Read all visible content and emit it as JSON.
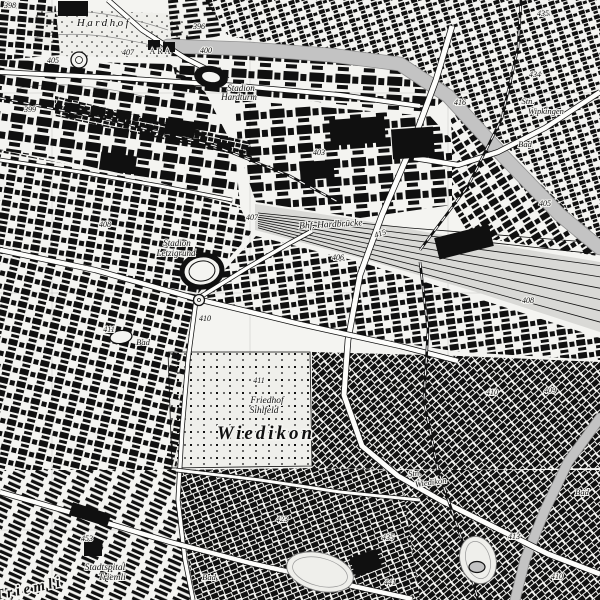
{
  "canvas": {
    "width": 600,
    "height": 600
  },
  "colors": {
    "background": "#f4f4f1",
    "ink": "#101010",
    "river": "#c3c3c3",
    "river_edge": "#909090",
    "yard": "#d9d9d6",
    "road_fill": "#fdfdfb",
    "grid": "#9a9a9a",
    "contour": "#8a8a8a",
    "area_light": "#efefeb"
  },
  "grid": {
    "vertical_x": [
      52,
      250,
      448
    ],
    "horizontal_y": [
      93,
      293,
      530
    ]
  },
  "parks": [
    {
      "name": "hardhof-park",
      "points": "38,8 178,14 196,44 168,58 58,56 30,30",
      "tile": "dots",
      "outline": false
    },
    {
      "name": "cemetery-sihlfeld",
      "points": "168,352 310,352 312,466 172,468",
      "tile": "cem",
      "outline": true
    }
  ],
  "contours": [
    "M40,14 C80,6 125,16 168,30",
    "M34,38 C82,28 130,40 172,50",
    "M20,88 C60,80 110,88 150,98"
  ],
  "districts": [
    {
      "name": "wipkingen-hoengg",
      "points": "205,0 600,0 600,240 585,228 518,158 455,96 392,58 300,48 228,36",
      "tile": "small",
      "rotate": -18
    },
    {
      "name": "hardturm-strip",
      "points": "170,52 300,57 400,67 446,98 428,114 300,100 178,88",
      "tile": "large",
      "rotate": 3
    },
    {
      "name": "top-left-blocks",
      "points": "0,0 55,0 60,55 0,60",
      "tile": "med",
      "rotate": 5
    },
    {
      "name": "altstetten-nord",
      "points": "0,60 170,64 205,92 235,150 240,205 150,180 60,160 0,150",
      "tile": "large",
      "rotate": 8
    },
    {
      "name": "letzi-west",
      "points": "0,150 150,182 240,207 252,232 196,296 95,268 0,248",
      "tile": "med",
      "rotate": 10
    },
    {
      "name": "hard-industrial",
      "points": "235,100 430,116 452,140 452,205 360,218 256,202 238,150",
      "tile": "large",
      "rotate": -4
    },
    {
      "name": "kreis5",
      "points": "450,104 516,160 584,226 598,244 598,256 470,236 452,205 452,140",
      "tile": "med",
      "rotate": -32
    },
    {
      "name": "center-band",
      "points": "200,296 256,236 360,262 470,296 600,338 600,360 460,352 330,332 252,314",
      "tile": "med",
      "rotate": -8
    },
    {
      "name": "sihlfeld-east",
      "points": "312,352 460,356 600,362 600,468 460,470 312,468",
      "tile": "dense",
      "rotate": -42
    },
    {
      "name": "west-of-cemetery",
      "points": "0,250 95,270 196,300 188,360 180,440 176,470 0,470",
      "tile": "med",
      "rotate": 14
    },
    {
      "name": "friesenberg",
      "points": "0,470 176,470 180,520 192,600 0,600",
      "tile": "rows",
      "rotate": 24
    },
    {
      "name": "wiedikon-sued",
      "points": "176,470 312,468 400,470 420,600 196,600 184,540",
      "tile": "dense",
      "rotate": -22
    },
    {
      "name": "kreis3-sued-ost",
      "points": "400,470 600,470 600,600 420,600",
      "tile": "dense",
      "rotate": -40
    },
    {
      "name": "rail-industrial-band",
      "points": "55,96 250,142 252,158 55,116",
      "tile": "dense",
      "rotate": 12
    },
    {
      "name": "hoengg-foot",
      "points": "168,0 208,0 226,34 172,48",
      "tile": "rows",
      "rotate": -6
    }
  ],
  "yard": {
    "name": "rail-yard-hardbruecke",
    "points": "255,204 360,220 470,240 600,262 600,332 470,290 360,258 255,230",
    "tracks": 8
  },
  "rivers": [
    {
      "name": "limmat-river",
      "points": "168,46 250,49 330,55 400,64 448,96 505,158 560,215 600,248",
      "width": 13
    },
    {
      "name": "sihl-river",
      "points": "600,418 568,462 545,510 525,560 515,600",
      "width": 9
    }
  ],
  "roads": [
    {
      "name": "hardbruecke-road",
      "points": "452,26 436,80 410,150 382,215 360,275 348,340 344,395 362,446 398,476 442,501 492,526 548,554 600,574",
      "width": 5
    },
    {
      "name": "riverside-road",
      "points": "0,72 120,78 240,86 340,95 420,106",
      "width": 4
    },
    {
      "name": "north-road",
      "points": "108,0 142,30 185,58 228,80",
      "width": 4
    },
    {
      "name": "rosengarten-road",
      "points": "600,92 545,128 498,152 458,165 414,158",
      "width": 4.5
    },
    {
      "name": "badenerstrasse",
      "points": "0,250 95,270 197,299 300,324 400,346 458,361",
      "width": 4.5
    },
    {
      "name": "cemetery-west-road",
      "points": "196,300 188,360 182,430 178,500 185,560 193,600",
      "width": 3.5
    },
    {
      "name": "birmensdorferstrasse",
      "points": "0,492 90,518 170,542 250,563 330,581 412,599",
      "width": 4.5
    },
    {
      "name": "hardplatz-road",
      "points": "197,299 247,268 290,243 312,231",
      "width": 3.5
    },
    {
      "name": "letzi-road",
      "points": "0,160 80,172 160,186 232,200",
      "width": 3
    },
    {
      "name": "wiedikon-road",
      "points": "176,470 260,480 340,492 420,500",
      "width": 3
    }
  ],
  "railways": [
    {
      "name": "rail-altstetten",
      "points": "0,98 110,120 215,146 290,176 340,203"
    },
    {
      "name": "rail-wipkingen",
      "points": "420,250 468,186 502,118 518,48 521,0"
    },
    {
      "name": "rail-wiedikon",
      "points": "420,262 428,330 424,400 438,470 462,540 478,600"
    }
  ],
  "shapes": {
    "stadiums": [
      {
        "name": "stadion-hardturm",
        "cx": 211,
        "cy": 77,
        "rx": 17,
        "ry": 11,
        "rot": 10,
        "style": "filled"
      },
      {
        "name": "stadion-letzigrund",
        "cx": 202,
        "cy": 271,
        "rx": 20,
        "ry": 16,
        "rot": -8,
        "style": "ring"
      }
    ],
    "ovals": [
      {
        "name": "sports-oval",
        "cx": 320,
        "cy": 572,
        "rx": 34,
        "ry": 19,
        "rot": 14
      },
      {
        "name": "park-oval",
        "cx": 478,
        "cy": 560,
        "rx": 18,
        "ry": 24,
        "rot": -15
      }
    ],
    "pools": [
      {
        "name": "bad-pool",
        "cx": 121,
        "cy": 337,
        "rx": 11,
        "ry": 6.5,
        "rot": -8,
        "filled": false
      },
      {
        "name": "pond",
        "cx": 477,
        "cy": 567,
        "rx": 8,
        "ry": 5.5,
        "rot": 0,
        "filled": true
      }
    ],
    "circles": [
      {
        "name": "roundabout",
        "cx": 199,
        "cy": 300,
        "r": 5.5
      },
      {
        "name": "roundabout",
        "cx": 97,
        "cy": 546,
        "r": 5
      },
      {
        "name": "tank",
        "cx": 79,
        "cy": 60,
        "r": 8
      }
    ],
    "blocks": [
      [
        58,
        1,
        30,
        15,
        0
      ],
      [
        330,
        118,
        55,
        26,
        -4
      ],
      [
        392,
        128,
        42,
        30,
        -4
      ],
      [
        300,
        161,
        34,
        18,
        -4
      ],
      [
        436,
        231,
        56,
        22,
        -14
      ],
      [
        165,
        120,
        30,
        16,
        8
      ],
      [
        100,
        154,
        36,
        18,
        8
      ],
      [
        70,
        508,
        40,
        13,
        18
      ],
      [
        84,
        540,
        18,
        16,
        0
      ],
      [
        352,
        553,
        28,
        20,
        -20
      ],
      [
        148,
        40,
        12,
        10,
        0
      ],
      [
        163,
        42,
        12,
        10,
        0
      ]
    ]
  },
  "labels": [
    {
      "t": "398",
      "x": 10,
      "y": 8,
      "s": 8,
      "i": 1
    },
    {
      "t": "Hardhof",
      "x": 104,
      "y": 26,
      "s": 11,
      "i": 1,
      "ls": 2.5
    },
    {
      "t": "405",
      "x": 53,
      "y": 63,
      "s": 8,
      "i": 1
    },
    {
      "t": "407",
      "x": 128,
      "y": 55,
      "s": 8,
      "i": 1
    },
    {
      "t": "ARA",
      "x": 161,
      "y": 54,
      "s": 8,
      "ls": 2
    },
    {
      "t": "396",
      "x": 199,
      "y": 29,
      "s": 8,
      "i": 1
    },
    {
      "t": "400",
      "x": 206,
      "y": 53,
      "s": 8,
      "i": 1
    },
    {
      "t": "399",
      "x": 30,
      "y": 112,
      "s": 8,
      "i": 1
    },
    {
      "t": "435",
      "x": 543,
      "y": 16,
      "s": 8,
      "i": 1
    },
    {
      "t": "434",
      "x": 535,
      "y": 77,
      "s": 8,
      "i": 1
    },
    {
      "t": "416",
      "x": 460,
      "y": 105,
      "s": 8,
      "i": 1
    },
    {
      "t": "Stn.",
      "x": 528,
      "y": 104,
      "s": 8.5,
      "i": 1
    },
    {
      "t": "Wipkingen",
      "x": 546,
      "y": 114,
      "s": 8.5,
      "i": 1
    },
    {
      "t": "Bad",
      "x": 525,
      "y": 147,
      "s": 8.5,
      "i": 1
    },
    {
      "t": "403",
      "x": 319,
      "y": 155,
      "s": 8,
      "i": 1
    },
    {
      "t": "Stadion",
      "x": 241,
      "y": 91,
      "s": 9,
      "i": 1
    },
    {
      "t": "Hardturm",
      "x": 239,
      "y": 100,
      "s": 9,
      "i": 1
    },
    {
      "t": "Bhf. Hardbrücke",
      "x": 331,
      "y": 227,
      "s": 9.5,
      "i": 1,
      "r": -3
    },
    {
      "t": "415",
      "x": 381,
      "y": 236,
      "s": 8,
      "i": 1,
      "r": -20
    },
    {
      "t": "407",
      "x": 252,
      "y": 220,
      "s": 8,
      "i": 1
    },
    {
      "t": "406",
      "x": 338,
      "y": 260,
      "s": 8,
      "i": 1
    },
    {
      "t": "Stadion",
      "x": 177,
      "y": 246,
      "s": 9,
      "i": 1
    },
    {
      "t": "Letzigrund",
      "x": 176,
      "y": 256,
      "s": 9,
      "i": 1
    },
    {
      "t": "408",
      "x": 105,
      "y": 227,
      "s": 8,
      "i": 1
    },
    {
      "t": "410",
      "x": 205,
      "y": 321,
      "s": 8,
      "i": 1
    },
    {
      "t": "411",
      "x": 109,
      "y": 332,
      "s": 8,
      "i": 1
    },
    {
      "t": "Bad",
      "x": 143,
      "y": 345,
      "s": 8.5,
      "i": 1
    },
    {
      "t": "405",
      "x": 545,
      "y": 206,
      "s": 8,
      "i": 1
    },
    {
      "t": "408",
      "x": 528,
      "y": 303,
      "s": 8,
      "i": 1
    },
    {
      "t": "410",
      "x": 492,
      "y": 395,
      "s": 8,
      "i": 1
    },
    {
      "t": "409",
      "x": 550,
      "y": 393,
      "s": 8,
      "i": 1
    },
    {
      "t": "411",
      "x": 259,
      "y": 383,
      "s": 8,
      "i": 1
    },
    {
      "t": "Friedhof",
      "x": 267,
      "y": 403,
      "s": 9.5,
      "i": 1
    },
    {
      "t": "Sihlfeld",
      "x": 264,
      "y": 413,
      "s": 9.5,
      "i": 1
    },
    {
      "t": "Wiedikon",
      "x": 266,
      "y": 439,
      "s": 19,
      "i": 1,
      "w": 700,
      "ls": 3
    },
    {
      "t": "Stn.",
      "x": 415,
      "y": 476,
      "s": 8.5,
      "i": 1,
      "r": -8
    },
    {
      "t": "Wiedikon",
      "x": 431,
      "y": 485,
      "s": 8.5,
      "i": 1,
      "r": -8
    },
    {
      "t": "Bad",
      "x": 582,
      "y": 495,
      "s": 8.5,
      "i": 1
    },
    {
      "t": "423",
      "x": 282,
      "y": 522,
      "s": 8,
      "i": 1
    },
    {
      "t": "435",
      "x": 388,
      "y": 540,
      "s": 8,
      "i": 1
    },
    {
      "t": "413",
      "x": 514,
      "y": 539,
      "s": 8,
      "i": 1
    },
    {
      "t": "453",
      "x": 87,
      "y": 541,
      "s": 8,
      "i": 1
    },
    {
      "t": "Stadtspital",
      "x": 105,
      "y": 570,
      "s": 9.5,
      "i": 1
    },
    {
      "t": "Triemli",
      "x": 112,
      "y": 580,
      "s": 9.5,
      "i": 1
    },
    {
      "t": "Bad",
      "x": 209,
      "y": 580,
      "s": 8.5,
      "i": 1
    },
    {
      "t": "441",
      "x": 390,
      "y": 585,
      "s": 8,
      "i": 1
    },
    {
      "t": "410",
      "x": 557,
      "y": 579,
      "s": 8,
      "i": 1
    },
    {
      "t": "Triemli",
      "x": 30,
      "y": 593,
      "s": 15,
      "i": 1,
      "w": 700,
      "ls": 3.5,
      "r": -12
    }
  ]
}
